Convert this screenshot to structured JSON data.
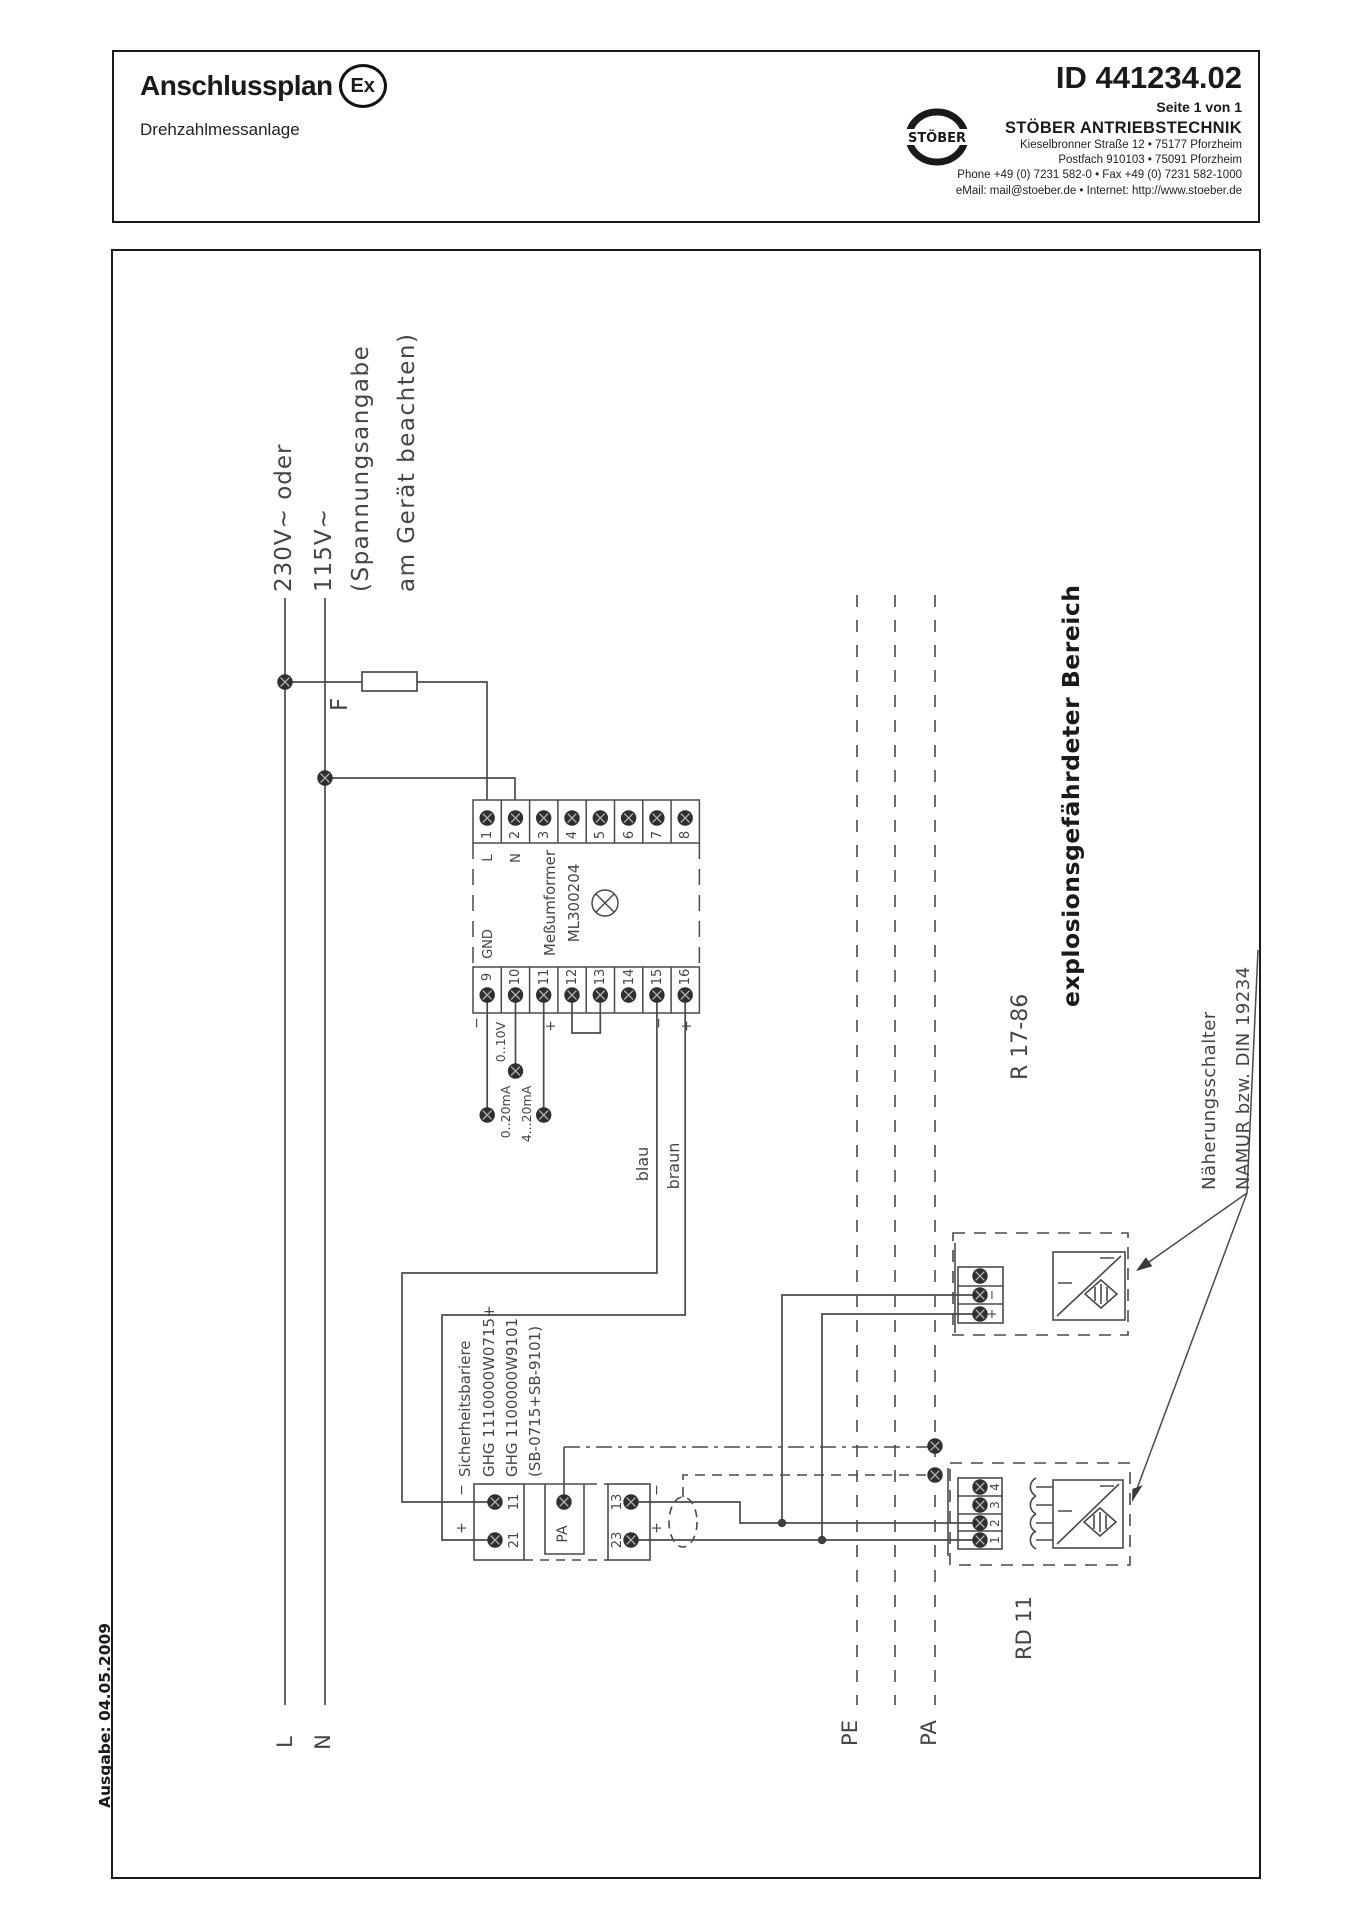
{
  "header": {
    "title": "Anschlussplan",
    "ex_badge": "Ex",
    "subtitle": "Drehzahlmessanlage",
    "doc_id": "ID 441234.02",
    "page_info": "Seite 1 von 1",
    "logo_text": "STÖBER",
    "company": "STÖBER ANTRIEBSTECHNIK",
    "address_line1": "Kieselbronner Straße 12 • 75177 Pforzheim",
    "address_line2": "Postfach 910103 • 75091 Pforzheim",
    "address_line3": "Phone +49 (0) 7231 582-0 • Fax +49 (0) 7231 582-1000",
    "address_line4": "eMail: mail@stoeber.de • Internet: http://www.stoeber.de"
  },
  "footer": {
    "issue": "Ausgabe: 04.05.2009"
  },
  "diagram": {
    "supply": {
      "voltage_primary": "230V~ oder",
      "voltage_secondary": "115V~",
      "note_line1": "(Spannungsangabe",
      "note_line2": "am Gerät beachten)",
      "fuse_label": "F",
      "phase_label": "L",
      "neutral_label": "N"
    },
    "transducer": {
      "name_line1": "Meßumformer",
      "name_line2": "ML300204",
      "gnd_label": "GND",
      "l_label": "L",
      "n_label": "N",
      "terminals_top": [
        "1",
        "2",
        "3",
        "4",
        "5",
        "6",
        "7",
        "8"
      ],
      "terminals_bottom": [
        "9",
        "10",
        "11",
        "12",
        "13",
        "14",
        "15",
        "16"
      ],
      "minus": "−",
      "plus": "+",
      "range_voltage": "0..10V",
      "range_current1": "0..20mA",
      "range_current2": "4...20mA"
    },
    "wires": {
      "blue_label": "blau",
      "brown_label": "braun"
    },
    "barrier": {
      "name": "Sicherheitsbariere",
      "type_line1": "GHG 1110000W0715+",
      "type_line2": "GHG 1100000W9101",
      "type_line3": "(SB-0715+SB-9101)",
      "t11": "11",
      "t21": "21",
      "t13": "13",
      "t23": "23",
      "tpa": "PA",
      "minus": "−",
      "plus": "+"
    },
    "buses": {
      "pe_label": "PE",
      "pa_label": "PA"
    },
    "ex_zone_label": "explosionsgefährdeter  Bereich",
    "sensors": {
      "upper_model": "R 17-86",
      "lower_model": "RD 11",
      "minus": "−",
      "plus": "+",
      "lower_terminals": [
        "4",
        "3",
        "2",
        "1"
      ],
      "note_line1": "Näherungsschalter",
      "note_line2": "NAMUR bzw. DIN 19234"
    }
  },
  "colors": {
    "line": "#4a4a4a",
    "text": "#454545",
    "frame": "#1a1a1a"
  }
}
